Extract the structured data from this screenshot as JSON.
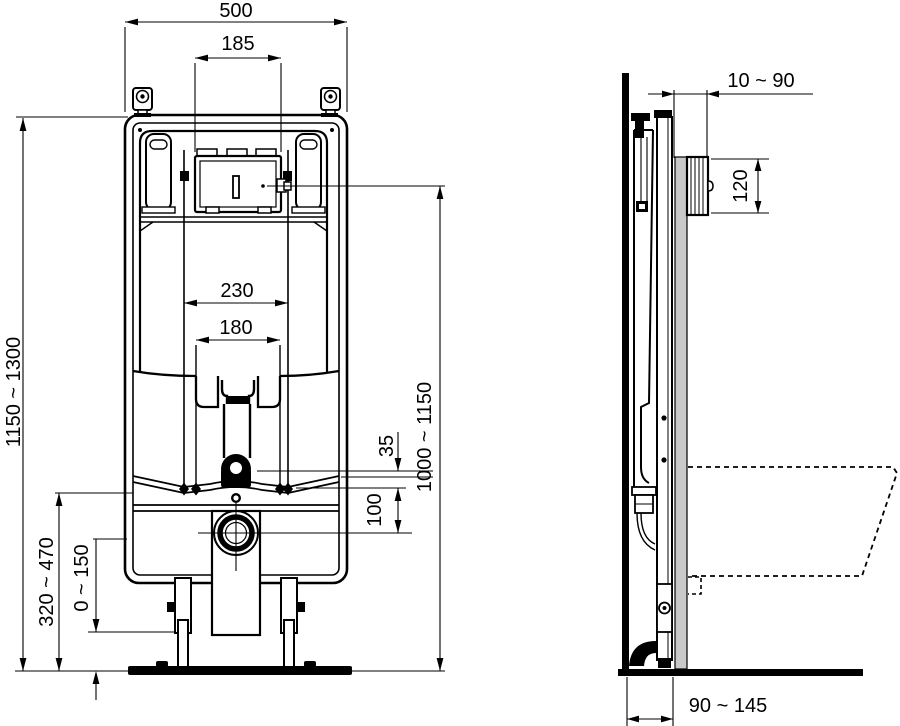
{
  "dims": {
    "front": {
      "width": "500",
      "plate_width": "185",
      "fix_outer": "230",
      "fix_inner": "180",
      "height": "1150 ~ 1300",
      "outlet_height": "320 ~ 470",
      "leg_adjust": "0 ~ 150",
      "d35": "35",
      "d100": "100",
      "actuator_height": "1000 ~ 1150"
    },
    "side": {
      "recess": "10 ~ 90",
      "plate_height": "120",
      "depth": "90 ~ 145"
    }
  },
  "colors": {
    "line": "#000000",
    "wall_finish": "#c9c9c9",
    "background": "#ffffff"
  }
}
